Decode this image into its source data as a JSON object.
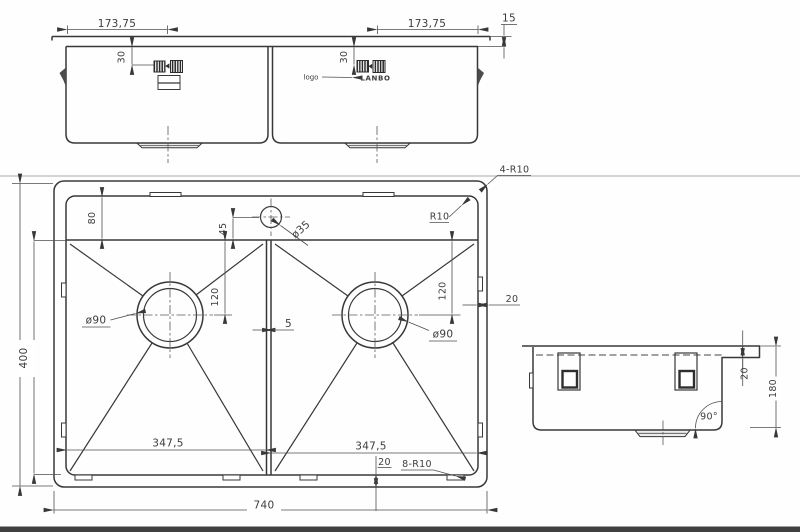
{
  "front_view": {
    "dim_left": "173,75",
    "dim_right": "173,75",
    "rim_height": "15",
    "clip_offset_left": "30",
    "clip_offset_right": "30",
    "logo_label": "logo",
    "brand": "LANBO"
  },
  "plan_view": {
    "overall_width": "740",
    "overall_depth": "400",
    "deck_depth": "80",
    "faucet_offset": "45",
    "faucet_hole": "ø35",
    "bowl_width_left": "347,5",
    "bowl_width_right": "347,5",
    "drain_left": "ø90",
    "drain_right": "ø90",
    "drain_offset_left": "120",
    "drain_offset_right": "120",
    "divider_gap": "5",
    "rim_side": "20",
    "rim_bottom": "20",
    "outer_corner_radius": "4-R10",
    "inner_corner_radius": "R10",
    "bowl_corner_radius": "8-R10"
  },
  "side_view": {
    "rim_height": "20",
    "bowl_depth": "180",
    "wall_angle": "90°"
  }
}
